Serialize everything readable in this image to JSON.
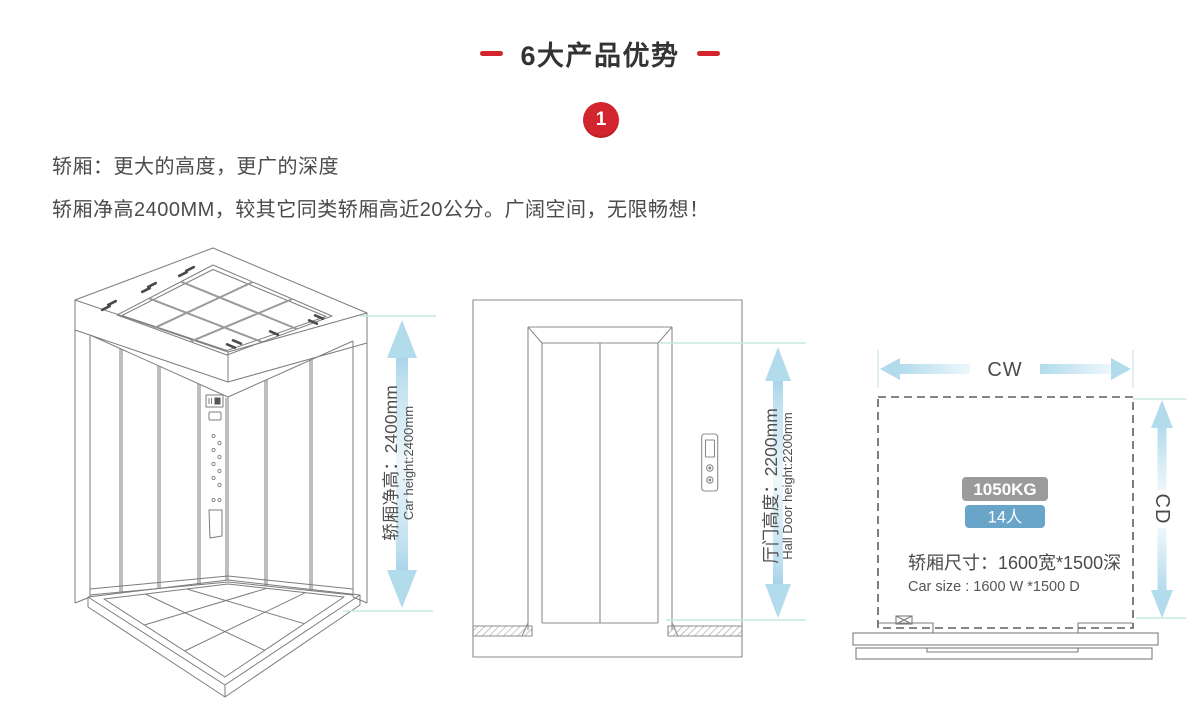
{
  "header": {
    "title": "6大产品优势",
    "advantage_number": "1"
  },
  "intro": {
    "line1": "轿厢：更大的高度，更广的深度",
    "line2": "轿厢净高2400MM，较其它同类轿厢高近20公分。广阔空间，无限畅想！"
  },
  "car_diagram": {
    "label_cn": "轿厢净高：2400mm",
    "label_en": "Car height:2400mm"
  },
  "door_diagram": {
    "label_cn": "厅门高度：2200mm",
    "label_en": "Hall Door height:2200mm"
  },
  "plan_diagram": {
    "width_label": "CW",
    "depth_label": "CD",
    "load_badge": "1050KG",
    "persons_badge": "14人",
    "size_cn": "轿厢尺寸：1600宽*1500深",
    "size_en": "Car size : 1600 W *1500 D"
  },
  "colors": {
    "accent_red": "#d2252d",
    "arrow_blue": "#b2dbec",
    "extension_teal": "#c9e8e2",
    "badge_gray": "#9b9b9b",
    "badge_blue": "#68a5c8",
    "line_gray": "#7d7d7d",
    "text_dark": "#4a4a4a"
  }
}
